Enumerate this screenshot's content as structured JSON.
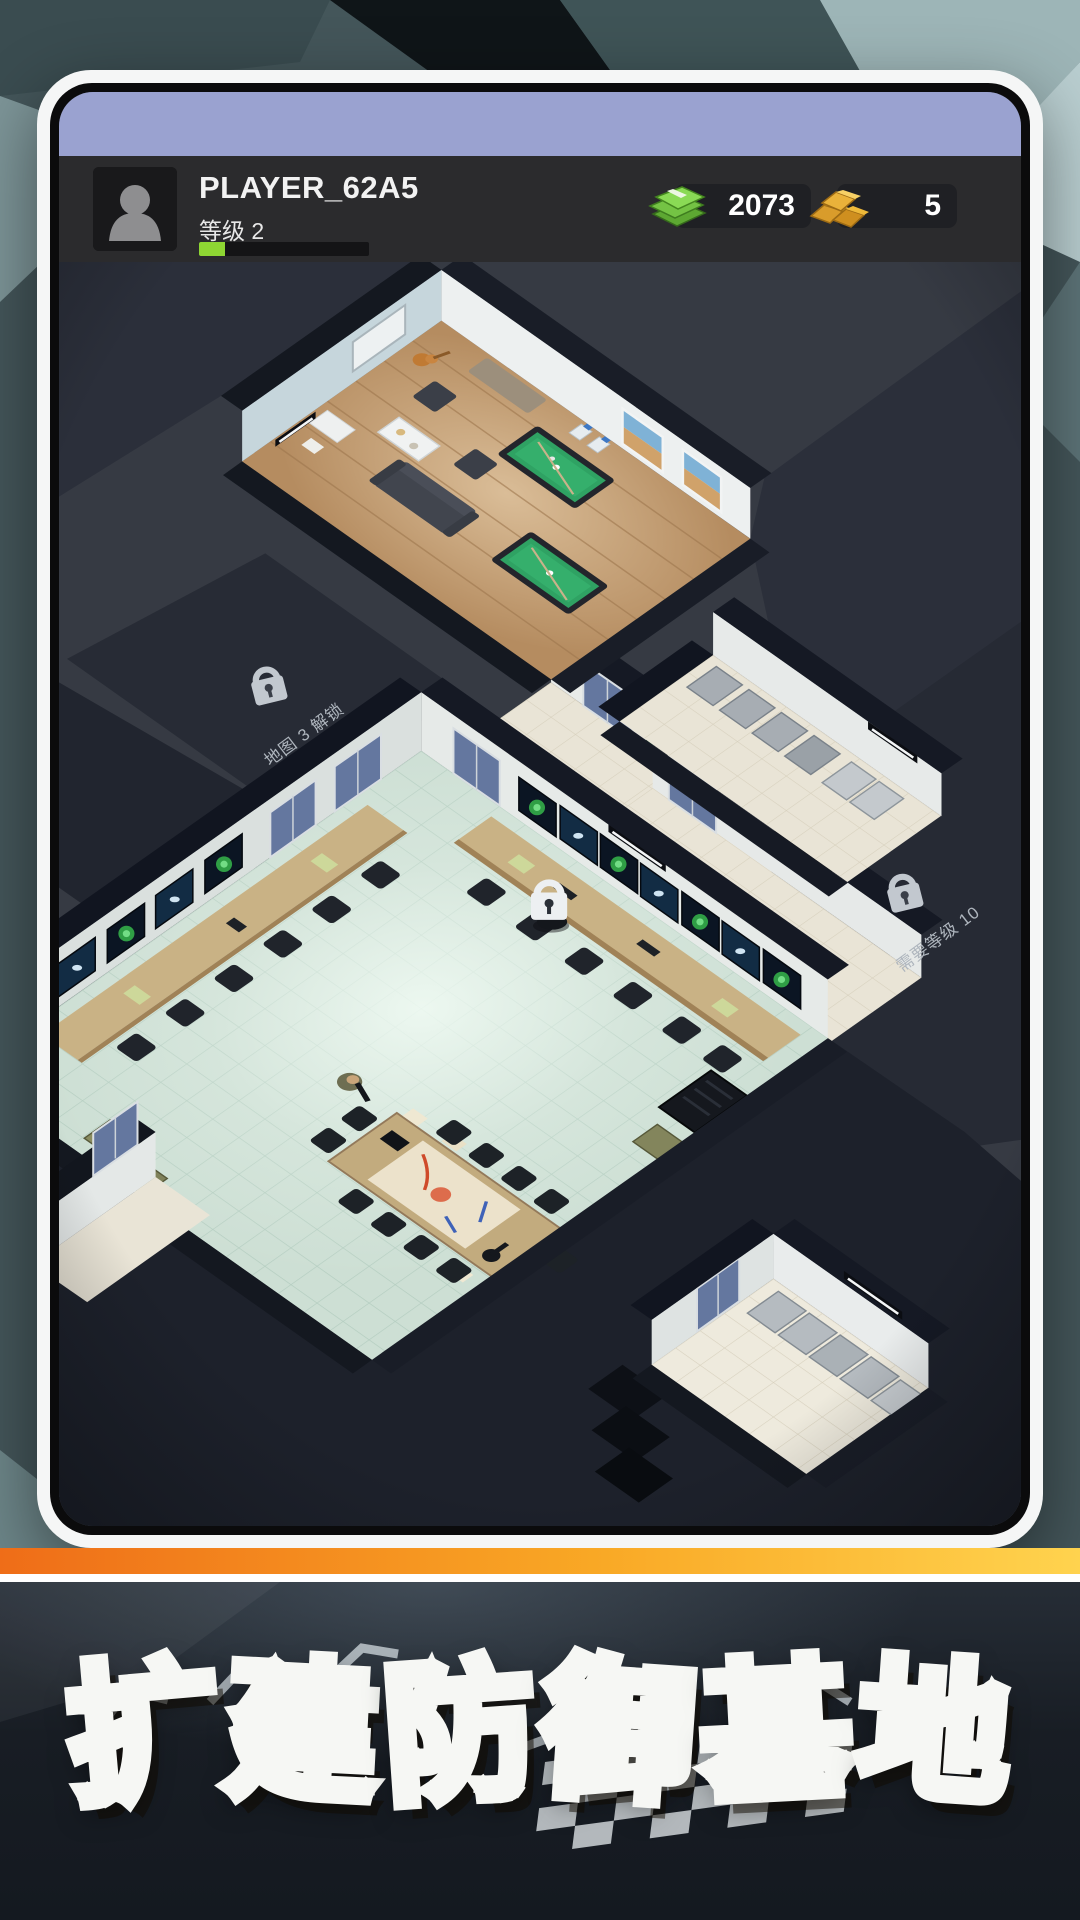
{
  "player": {
    "name": "PLAYER_62A5",
    "level_label": "等级 2",
    "xp_percent": 15
  },
  "currencies": {
    "cash": {
      "value": "2073",
      "icon": "cash-stack"
    },
    "gold": {
      "value": "5",
      "icon": "gold-bars"
    }
  },
  "locks": {
    "map_area": "地图 3 解锁",
    "level_area": "需要等级 10"
  },
  "banner": {
    "title": "扩建防御基地"
  },
  "colors": {
    "status_lavender": "#9aa2d0",
    "xp_green": "#8ed633",
    "cash_green": "#7ccc52",
    "gold": "#e8b33c",
    "banner_orange": "#f69320",
    "pool_table_green": "#2fa263",
    "door_blue": "#64779f"
  }
}
